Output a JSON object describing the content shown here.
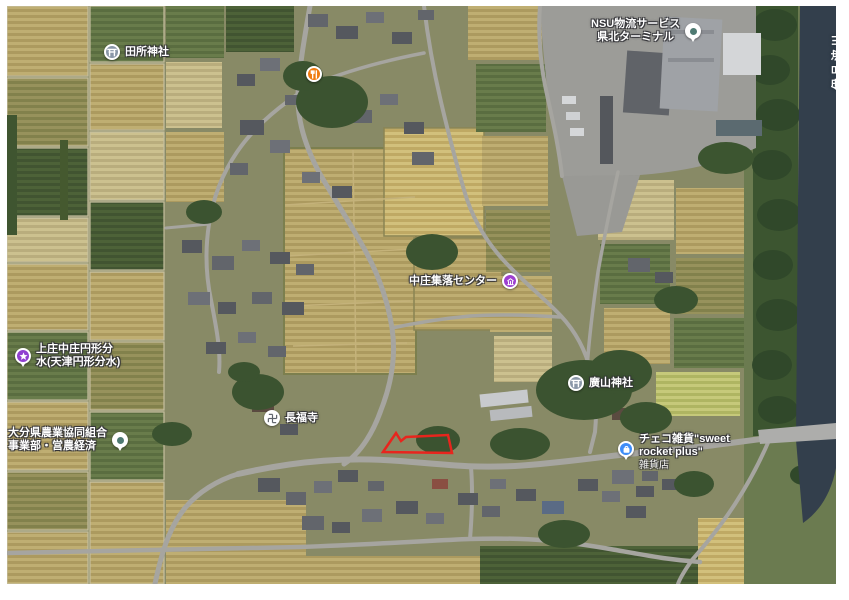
{
  "pois": {
    "tadokoro_shrine": {
      "name": "田所神社",
      "icon": "torii-shrine-icon"
    },
    "restaurant": {
      "name": "",
      "icon": "restaurant-icon"
    },
    "nsu_terminal": {
      "line1": "NSU物流サービス",
      "line2": "県北ターミナル",
      "icon": "generic-place-icon"
    },
    "community_center": {
      "name": "中庄集落センター",
      "icon": "civic-building-icon"
    },
    "enkei_bunsui": {
      "line1": "上庄中庄円形分",
      "line2": "水(天津円形分水)",
      "icon": "attraction-pin-icon"
    },
    "ja_oita": {
      "line1": "大分県農業協同組合",
      "line2": "事業部・営農経済",
      "icon": "generic-place-icon"
    },
    "chofukuji_temple": {
      "name": "長福寺",
      "icon": "manji-temple-icon"
    },
    "hiroyama_shrine": {
      "name": "廣山神社",
      "icon": "torii-shrine-icon"
    },
    "sweet_rocket_shop": {
      "line1": "チェコ雑貨\"sweet",
      "line2": "rocket plus\"",
      "category": "雑貨店",
      "icon": "shop-pin-icon"
    },
    "iroha_river": {
      "name": "伊呂波川"
    }
  },
  "overlay": {
    "parcel_outline": "selected-parcel-outline"
  },
  "colors": {
    "parcel_outline": "#e8251d",
    "label_text": "#ffffff",
    "shrine_icon_bg": "#8a97a8",
    "temple_icon_bg": "#ffffff",
    "temple_glyph": "#5f646c",
    "restaurant_icon_bg": "#ef7b10",
    "civic_icon_bg": "#9d3fd0",
    "attraction_icon_bg": "#8f3fd0",
    "shop_icon_bg": "#3e8df8",
    "generic_icon_bg": "#ffffff",
    "generic_icon_dot": "#4e7a72"
  }
}
